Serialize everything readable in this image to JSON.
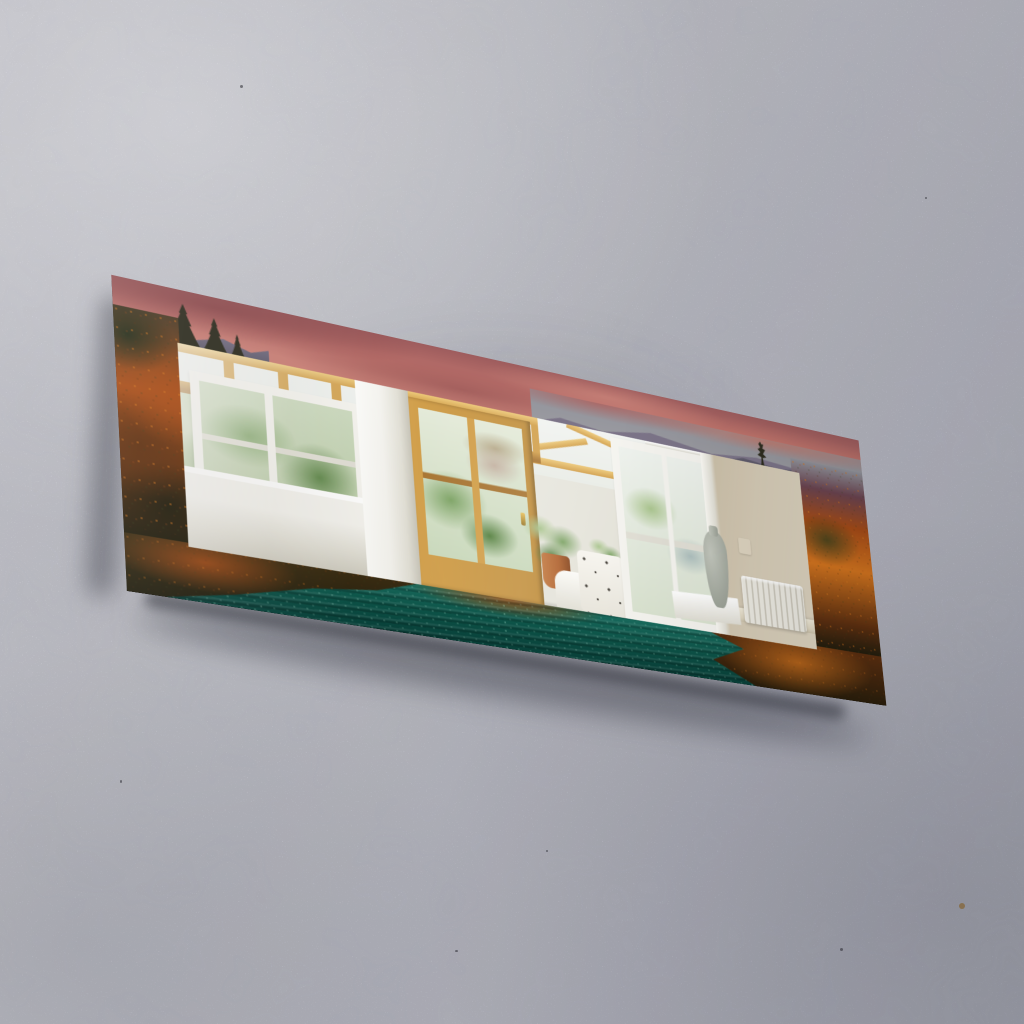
{
  "image": {
    "kind": "product-photo",
    "description": "Rectangular decorative wall mirror with a printed autumn-landscape canvas border (pink sunset clouds, orange forest, teal lake water), hung at an angle on a gray concrete wall; the mirror reflects an oak-framed conservatory interior with white windows, plants, a vase, a beige wall and a radiator."
  },
  "artwork": {
    "frame_motifs": [
      "pink sunset clouds",
      "gray evening sky",
      "mountain ridge",
      "pine silhouettes",
      "autumn orange foliage",
      "teal lake water with sparkles"
    ],
    "reflection_items": [
      "oak conservatory transom",
      "white sash window with greenery",
      "white column",
      "glazed oak door with brass handle",
      "glass gable roof",
      "potted plants",
      "white armchair with floral cushion",
      "white glazed door",
      "ceramic vase on ledge",
      "beige wall",
      "light switch",
      "white radiator",
      "skirting board"
    ],
    "construction": [
      "printed front face",
      "black layered side edge",
      "black bottom edge",
      "beveled mirror glass"
    ]
  },
  "colors": {
    "wall1": "#dfdfe7",
    "wall2": "#d3d4dc",
    "wall3": "#c3c4cf",
    "wall4": "#b4b6c1",
    "edge": "#0a0a0c",
    "edge2": "#26262c",
    "sky1": "#b86f6a",
    "sky2": "#c67f76",
    "sky3": "#9d5c5d",
    "graysky": "#91939b",
    "mtn1": "#7a7287",
    "mtn2": "#5f5b6b",
    "hillMaroon": "#6b4450",
    "pine": "#2e2d20",
    "fol1": "#a74c17",
    "fol2": "#d4751f",
    "fol3": "#5c2f10",
    "folGreen": "#36401d",
    "folDeep": "#1f1c0d",
    "water1": "#1a6e60",
    "water2": "#0c5146",
    "water3": "#083f38",
    "sparkle": "#a8e4cc",
    "oak": "#d2a04c",
    "oakLight": "#ecc878",
    "oakDark": "#a87634",
    "white1": "#f4f3ee",
    "white2": "#e0ded4",
    "white3": "#cfccc0",
    "glass": "#eef1ee",
    "glassGreen": "#c9d8bb",
    "green1": "#7da365",
    "green2": "#55803f",
    "green3": "#a9c48d",
    "brick": "#c4b2a2",
    "thatch": "#b7aa8b",
    "beige1": "#d3c8b2",
    "beige2": "#c8bca4",
    "beige3": "#dcd2bd",
    "rad": "#ebe9e0",
    "radShadow": "#c9c5b8",
    "terra": "#b06330",
    "cushionDot": "#45413a",
    "vase1": "#c2c6bc",
    "vase2": "#979d92"
  }
}
